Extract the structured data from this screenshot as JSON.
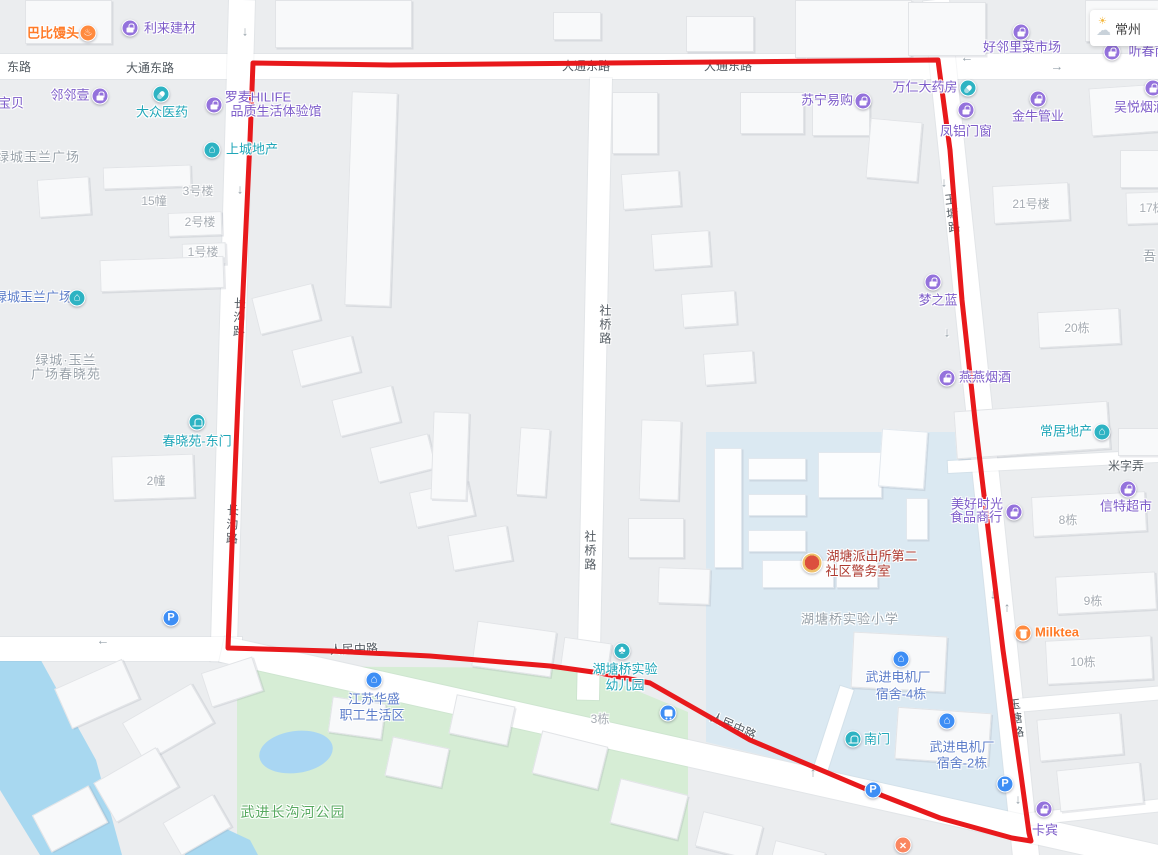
{
  "weather": {
    "city": "常州"
  },
  "route": {
    "color": "#e8191c",
    "points": "253,63 390,65 938,60 950,150 962,300 975,420 990,545 1003,650 1013,720 1021,775 1029,833 1031,841 1012,838 940,818 873,792 750,740 650,683 600,673 550,666 430,656 330,651 228,648 233,520 238,400 244,270 250,140 253,63"
  },
  "labels": [
    {
      "t": "东路",
      "x": 19,
      "y": 68,
      "s": "road"
    },
    {
      "t": "大通东路",
      "x": 150,
      "y": 69,
      "s": "road"
    },
    {
      "t": "大通东路",
      "x": 586,
      "y": 67,
      "s": "road"
    },
    {
      "t": "大通东路",
      "x": 728,
      "y": 67,
      "s": "road"
    },
    {
      "t": "人民中路",
      "x": 354,
      "y": 650,
      "s": "road",
      "a": -2
    },
    {
      "t": "人民中路",
      "x": 733,
      "y": 727,
      "s": "road",
      "a": 24
    },
    {
      "t": "社桥路",
      "x": 604,
      "y": 325,
      "s": "road",
      "v": 1
    },
    {
      "t": "社桥路",
      "x": 589,
      "y": 551,
      "s": "road",
      "v": 1
    },
    {
      "t": "长沟路",
      "x": 238,
      "y": 318,
      "s": "road",
      "v": 1,
      "a": 2
    },
    {
      "t": "长沟路",
      "x": 231,
      "y": 525,
      "s": "road",
      "v": 1,
      "a": 2
    },
    {
      "t": "玉塘路",
      "x": 951,
      "y": 214,
      "s": "road",
      "v": 1,
      "a": -7
    },
    {
      "t": "玉塘路",
      "x": 1015,
      "y": 719,
      "s": "road",
      "v": 1,
      "a": -7
    },
    {
      "t": "米字弄",
      "x": 1126,
      "y": 467,
      "s": "road"
    },
    {
      "t": "巴比馒头",
      "x": 53,
      "y": 34,
      "s": "orange"
    },
    {
      "t": "利来建材",
      "x": 170,
      "y": 29,
      "s": "purple"
    },
    {
      "t": "宝贝",
      "x": 11,
      "y": 104,
      "s": "purple"
    },
    {
      "t": "邻邻壹",
      "x": 70,
      "y": 96,
      "s": "purple"
    },
    {
      "t": "大众医药",
      "x": 162,
      "y": 113,
      "s": "teal"
    },
    {
      "t": "罗麦HILIFE",
      "x": 258,
      "y": 98,
      "s": "purple"
    },
    {
      "t": "品质生活体验馆",
      "x": 276,
      "y": 112,
      "s": "purple"
    },
    {
      "t": "上城地产",
      "x": 252,
      "y": 150,
      "s": "teal"
    },
    {
      "t": "绿城玉兰广场",
      "x": 38,
      "y": 158,
      "s": "area"
    },
    {
      "t": "15幢",
      "x": 154,
      "y": 202,
      "s": "bldg"
    },
    {
      "t": "3号楼",
      "x": 198,
      "y": 192,
      "s": "bldg"
    },
    {
      "t": "2号楼",
      "x": 200,
      "y": 223,
      "s": "bldg"
    },
    {
      "t": "1号楼",
      "x": 203,
      "y": 253,
      "s": "bldg"
    },
    {
      "t": "绿城玉兰广场",
      "x": 33,
      "y": 298,
      "s": "blue"
    },
    {
      "t": "绿城·玉兰",
      "x": 66,
      "y": 361,
      "s": "area"
    },
    {
      "t": "广场春晓苑",
      "x": 66,
      "y": 375,
      "s": "area"
    },
    {
      "t": "春晓苑-东门",
      "x": 197,
      "y": 442,
      "s": "teal"
    },
    {
      "t": "2幢",
      "x": 156,
      "y": 482,
      "s": "bldg"
    },
    {
      "t": "苏宁易购",
      "x": 827,
      "y": 101,
      "s": "purple"
    },
    {
      "t": "万仁大药房",
      "x": 925,
      "y": 88,
      "s": "purple"
    },
    {
      "t": "凤铝门窗",
      "x": 966,
      "y": 132,
      "s": "purple"
    },
    {
      "t": "金牛管业",
      "x": 1038,
      "y": 117,
      "s": "purple"
    },
    {
      "t": "好邻里菜市场",
      "x": 1022,
      "y": 48,
      "s": "purple"
    },
    {
      "t": "吴悦烟酒",
      "x": 1140,
      "y": 108,
      "s": "purple"
    },
    {
      "t": "听春南",
      "x": 1148,
      "y": 52,
      "s": "purple"
    },
    {
      "t": "21号楼",
      "x": 1031,
      "y": 205,
      "s": "bldg"
    },
    {
      "t": "17栋",
      "x": 1152,
      "y": 209,
      "s": "bldg"
    },
    {
      "t": "吾",
      "x": 1150,
      "y": 257,
      "s": "area"
    },
    {
      "t": "梦之蓝",
      "x": 938,
      "y": 301,
      "s": "purple"
    },
    {
      "t": "20栋",
      "x": 1077,
      "y": 329,
      "s": "bldg"
    },
    {
      "t": "燕燕烟酒",
      "x": 985,
      "y": 378,
      "s": "purple"
    },
    {
      "t": "常居地产",
      "x": 1066,
      "y": 432,
      "s": "teal"
    },
    {
      "t": "信特超市",
      "x": 1126,
      "y": 507,
      "s": "purple"
    },
    {
      "t": "美好时光",
      "x": 977,
      "y": 505,
      "s": "purple"
    },
    {
      "t": "食品商行",
      "x": 976,
      "y": 518,
      "s": "purple"
    },
    {
      "t": "8栋",
      "x": 1068,
      "y": 521,
      "s": "bldg"
    },
    {
      "t": "9栋",
      "x": 1093,
      "y": 602,
      "s": "bldg"
    },
    {
      "t": "Milktea",
      "x": 1057,
      "y": 633,
      "s": "orange"
    },
    {
      "t": "10栋",
      "x": 1083,
      "y": 663,
      "s": "bldg"
    },
    {
      "t": "卡宾",
      "x": 1045,
      "y": 831,
      "s": "purple"
    },
    {
      "t": "湖塘派出所第二",
      "x": 872,
      "y": 557,
      "s": "red"
    },
    {
      "t": "社区警务室",
      "x": 858,
      "y": 572,
      "s": "red"
    },
    {
      "t": "湖塘桥实验小学",
      "x": 850,
      "y": 620,
      "s": "area"
    },
    {
      "t": "湖塘桥实验",
      "x": 625,
      "y": 670,
      "s": "teal"
    },
    {
      "t": "幼儿园",
      "x": 625,
      "y": 686,
      "s": "teal"
    },
    {
      "t": "3栋",
      "x": 600,
      "y": 720,
      "s": "bldg"
    },
    {
      "t": "南门",
      "x": 877,
      "y": 740,
      "s": "teal"
    },
    {
      "t": "武进电机厂",
      "x": 898,
      "y": 678,
      "s": "blue"
    },
    {
      "t": "宿舍-4栋",
      "x": 901,
      "y": 695,
      "s": "blue"
    },
    {
      "t": "武进电机厂",
      "x": 962,
      "y": 748,
      "s": "blue"
    },
    {
      "t": "宿舍-2栋",
      "x": 962,
      "y": 764,
      "s": "blue"
    },
    {
      "t": "江苏华盛",
      "x": 374,
      "y": 700,
      "s": "blue"
    },
    {
      "t": "职工生活区",
      "x": 372,
      "y": 716,
      "s": "blue"
    },
    {
      "t": "武进长沟河公园",
      "x": 293,
      "y": 812,
      "s": "green"
    }
  ],
  "icons": [
    {
      "type": "hand",
      "x": 88,
      "y": 33,
      "c": "orange"
    },
    {
      "type": "bag",
      "x": 130,
      "y": 28,
      "c": "purple"
    },
    {
      "type": "bag",
      "x": 100,
      "y": 96,
      "c": "purple"
    },
    {
      "type": "pill",
      "x": 161,
      "y": 94,
      "c": "teal"
    },
    {
      "type": "bag",
      "x": 214,
      "y": 105,
      "c": "purple"
    },
    {
      "type": "building",
      "x": 212,
      "y": 150,
      "c": "teal"
    },
    {
      "type": "building",
      "x": 77,
      "y": 298,
      "c": "teal"
    },
    {
      "type": "door",
      "x": 197,
      "y": 422,
      "c": "teal"
    },
    {
      "type": "bag",
      "x": 863,
      "y": 101,
      "c": "purple"
    },
    {
      "type": "pill",
      "x": 968,
      "y": 88,
      "c": "teal"
    },
    {
      "type": "bag",
      "x": 966,
      "y": 110,
      "c": "purple"
    },
    {
      "type": "bag",
      "x": 1038,
      "y": 99,
      "c": "purple"
    },
    {
      "type": "bag",
      "x": 1021,
      "y": 32,
      "c": "purple"
    },
    {
      "type": "bag",
      "x": 1153,
      "y": 88,
      "c": "purple"
    },
    {
      "type": "bag",
      "x": 1112,
      "y": 52,
      "c": "purple"
    },
    {
      "type": "bag",
      "x": 933,
      "y": 282,
      "c": "purple"
    },
    {
      "type": "bag",
      "x": 947,
      "y": 378,
      "c": "purple"
    },
    {
      "type": "building",
      "x": 1102,
      "y": 432,
      "c": "teal"
    },
    {
      "type": "bag",
      "x": 1128,
      "y": 489,
      "c": "purple"
    },
    {
      "type": "bag",
      "x": 1014,
      "y": 512,
      "c": "purple"
    },
    {
      "type": "cup",
      "x": 1023,
      "y": 633,
      "c": "orange"
    },
    {
      "type": "bag",
      "x": 1044,
      "y": 809,
      "c": "purple"
    },
    {
      "type": "police",
      "x": 812,
      "y": 563,
      "c": "police"
    },
    {
      "type": "tree",
      "x": 622,
      "y": 651,
      "c": "teal"
    },
    {
      "type": "bus",
      "x": 668,
      "y": 713,
      "c": "blue"
    },
    {
      "type": "door",
      "x": 853,
      "y": 739,
      "c": "teal"
    },
    {
      "type": "building",
      "x": 901,
      "y": 659,
      "c": "blue"
    },
    {
      "type": "building",
      "x": 947,
      "y": 721,
      "c": "blue"
    },
    {
      "type": "building",
      "x": 374,
      "y": 680,
      "c": "blue"
    },
    {
      "type": "P",
      "x": 171,
      "y": 618,
      "c": "blue"
    },
    {
      "type": "P",
      "x": 873,
      "y": 790,
      "c": "blue"
    },
    {
      "type": "P",
      "x": 1005,
      "y": 784,
      "c": "blue"
    },
    {
      "type": "xmark",
      "x": 903,
      "y": 845,
      "c": "xorange"
    }
  ],
  "arrows": [
    {
      "g": "↓",
      "x": 245,
      "y": 31
    },
    {
      "g": "↓",
      "x": 240,
      "y": 189
    },
    {
      "g": "←",
      "x": 492,
      "y": 62
    },
    {
      "g": "←",
      "x": 810,
      "y": 58
    },
    {
      "g": "←",
      "x": 967,
      "y": 57
    },
    {
      "g": "→",
      "x": 1057,
      "y": 66
    },
    {
      "g": "↓",
      "x": 944,
      "y": 182
    },
    {
      "g": "↓",
      "x": 947,
      "y": 332
    },
    {
      "g": "↓",
      "x": 993,
      "y": 594
    },
    {
      "g": "↑",
      "x": 1007,
      "y": 607
    },
    {
      "g": "←",
      "x": 103,
      "y": 640
    },
    {
      "g": "←",
      "x": 280,
      "y": 647
    },
    {
      "g": "↑",
      "x": 813,
      "y": 772
    },
    {
      "g": "↓",
      "x": 1018,
      "y": 799
    }
  ],
  "buildings": [
    [
      25,
      0,
      85,
      42,
      0
    ],
    [
      275,
      0,
      135,
      46,
      0
    ],
    [
      553,
      12,
      46,
      26,
      0
    ],
    [
      686,
      16,
      66,
      34,
      0
    ],
    [
      795,
      0,
      115,
      56,
      0
    ],
    [
      908,
      2,
      76,
      52,
      0
    ],
    [
      1085,
      0,
      72,
      40,
      0
    ],
    [
      38,
      178,
      50,
      36,
      -4
    ],
    [
      103,
      166,
      86,
      20,
      -2
    ],
    [
      168,
      212,
      52,
      22,
      -2
    ],
    [
      182,
      243,
      42,
      20,
      -2
    ],
    [
      100,
      258,
      122,
      30,
      -2
    ],
    [
      112,
      455,
      80,
      42,
      -2
    ],
    [
      348,
      92,
      44,
      212,
      2
    ],
    [
      612,
      92,
      44,
      60,
      0
    ],
    [
      740,
      92,
      62,
      40,
      0
    ],
    [
      812,
      100,
      56,
      34,
      0
    ],
    [
      868,
      120,
      50,
      58,
      5
    ],
    [
      255,
      290,
      60,
      36,
      -14
    ],
    [
      295,
      342,
      60,
      36,
      -14
    ],
    [
      335,
      392,
      60,
      36,
      -14
    ],
    [
      373,
      440,
      58,
      34,
      -14
    ],
    [
      412,
      486,
      58,
      34,
      -12
    ],
    [
      450,
      530,
      58,
      34,
      -10
    ],
    [
      432,
      412,
      34,
      86,
      2
    ],
    [
      518,
      428,
      28,
      66,
      4
    ],
    [
      622,
      172,
      56,
      34,
      -4
    ],
    [
      652,
      232,
      56,
      34,
      -4
    ],
    [
      682,
      292,
      52,
      32,
      -4
    ],
    [
      704,
      352,
      48,
      30,
      -4
    ],
    [
      640,
      420,
      38,
      78,
      2
    ],
    [
      628,
      518,
      54,
      38,
      0
    ],
    [
      658,
      568,
      50,
      34,
      2
    ],
    [
      993,
      184,
      74,
      36,
      -3
    ],
    [
      1126,
      192,
      34,
      30,
      -2
    ],
    [
      1038,
      310,
      80,
      34,
      -3
    ],
    [
      1090,
      86,
      68,
      46,
      -4
    ],
    [
      1120,
      150,
      38,
      36,
      0
    ],
    [
      955,
      406,
      152,
      46,
      -4
    ],
    [
      1118,
      428,
      40,
      26,
      0
    ],
    [
      1032,
      494,
      112,
      38,
      -3
    ],
    [
      1056,
      574,
      98,
      36,
      -3
    ],
    [
      1046,
      638,
      104,
      42,
      -3
    ],
    [
      60,
      672,
      72,
      42,
      -24
    ],
    [
      128,
      700,
      78,
      44,
      -30
    ],
    [
      100,
      762,
      70,
      44,
      -30
    ],
    [
      38,
      798,
      62,
      40,
      -28
    ],
    [
      168,
      806,
      56,
      36,
      -30
    ],
    [
      205,
      664,
      52,
      34,
      -18
    ],
    [
      474,
      626,
      78,
      44,
      8
    ],
    [
      562,
      640,
      46,
      28,
      8
    ],
    [
      330,
      700,
      52,
      34,
      8
    ],
    [
      388,
      742,
      56,
      38,
      12
    ],
    [
      452,
      700,
      58,
      38,
      12
    ],
    [
      536,
      738,
      66,
      42,
      14
    ],
    [
      614,
      786,
      68,
      44,
      14
    ],
    [
      698,
      818,
      60,
      34,
      14
    ],
    [
      772,
      846,
      50,
      20,
      14
    ],
    [
      852,
      634,
      92,
      54,
      3
    ],
    [
      896,
      710,
      92,
      50,
      4
    ],
    [
      1038,
      716,
      82,
      40,
      -5
    ],
    [
      1058,
      766,
      82,
      40,
      -6
    ]
  ],
  "campus_buildings": [
    [
      714,
      448,
      26,
      118,
      0
    ],
    [
      748,
      458,
      56,
      20,
      0
    ],
    [
      748,
      494,
      56,
      20,
      0
    ],
    [
      748,
      530,
      56,
      20,
      0
    ],
    [
      818,
      452,
      62,
      44,
      0
    ],
    [
      880,
      430,
      44,
      56,
      4
    ],
    [
      906,
      498,
      20,
      40,
      0
    ],
    [
      762,
      560,
      70,
      26,
      0
    ],
    [
      836,
      560,
      40,
      26,
      0
    ]
  ]
}
